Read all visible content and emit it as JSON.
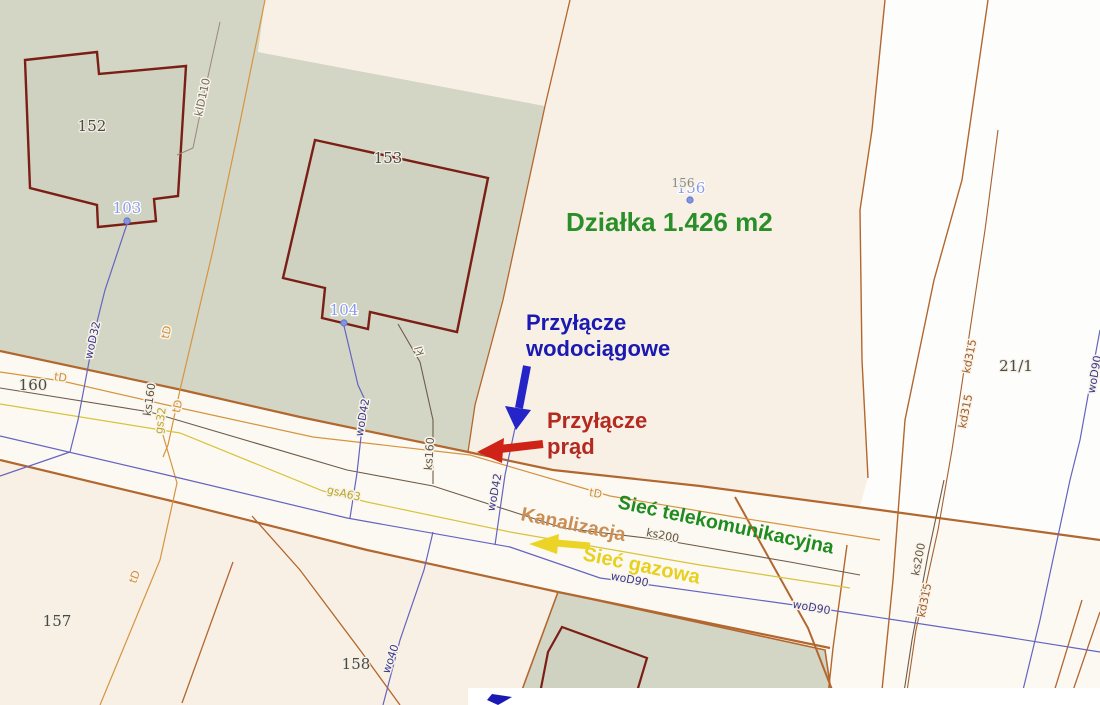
{
  "map": {
    "annotations": {
      "plot_area": {
        "text": "Działka 1.426 m2",
        "color": "#2a8f2a"
      },
      "water_connection": {
        "line1": "Przyłącze",
        "line2": "wodociągowe",
        "color": "#1a1ab2"
      },
      "power_connection": {
        "line1": "Przyłącze",
        "line2": "prąd",
        "color": "#b42a20"
      },
      "telecom_network": {
        "text": "Sieć telekomunikacyjna",
        "color": "#1f8c1f"
      },
      "sewer_network": {
        "text": "Kanalizacja",
        "color": "#c98f55"
      },
      "gas_network": {
        "text": "Sieć gazowa",
        "color": "#e8d01c"
      }
    },
    "parcels": [
      {
        "text": "152"
      },
      {
        "text": "153"
      },
      {
        "text": "157"
      },
      {
        "text": "158"
      },
      {
        "text": "160"
      },
      {
        "text": "21/1"
      },
      {
        "text": "103"
      },
      {
        "text": "104"
      },
      {
        "text": "156"
      },
      {
        "text": "156"
      }
    ],
    "utilities": [
      {
        "text": "klD110"
      },
      {
        "text": "woD32"
      },
      {
        "text": "tD"
      },
      {
        "text": "ks160"
      },
      {
        "text": "gs32"
      },
      {
        "text": "tD"
      },
      {
        "text": "tD"
      },
      {
        "text": "woD42"
      },
      {
        "text": "kl"
      },
      {
        "text": "ks160"
      },
      {
        "text": "gsA63"
      },
      {
        "text": "woD42"
      },
      {
        "text": "tD"
      },
      {
        "text": "ks200"
      },
      {
        "text": "woD90"
      },
      {
        "text": "woD90"
      },
      {
        "text": "ks200"
      },
      {
        "text": "kd315"
      },
      {
        "text": "kd315"
      },
      {
        "text": "kd315"
      },
      {
        "text": "wo40"
      },
      {
        "text": "tD"
      },
      {
        "text": "woD90"
      }
    ],
    "colors": {
      "background_cream": "#f8f0e4",
      "area_green": "#d4d6c5",
      "road_white": "#fcf9f3",
      "boundary_brown": "#b2672f",
      "building_maroon": "#7b1f16",
      "water_line_blue": "#6464c0",
      "telecom_line_orange": "#d59440",
      "gas_line_yellow": "#d8c33c",
      "sewer_line_dark": "#6f5b49"
    }
  }
}
